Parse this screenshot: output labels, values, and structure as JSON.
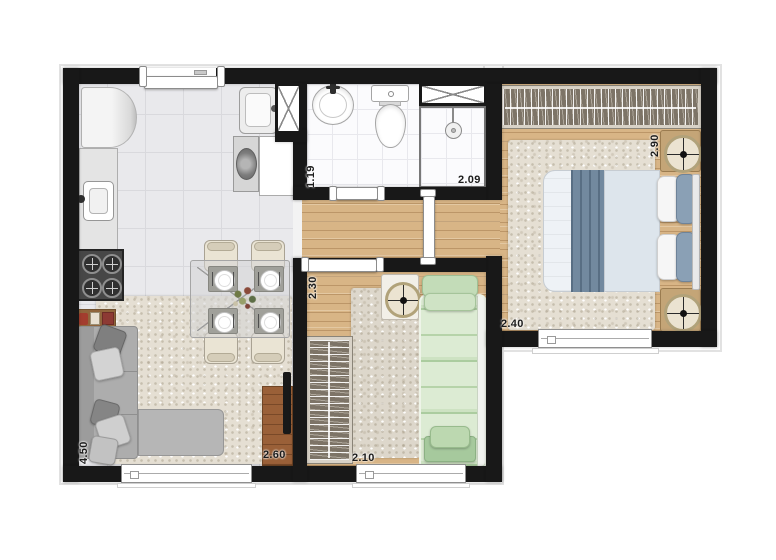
{
  "plan": {
    "type": "apartment-floor-plan",
    "dimensions": {
      "living_depth": "4.50",
      "living_width": "2.60",
      "bathroom_depth": "1.19",
      "bathroom_width": "2.09",
      "bedroom2_depth": "2.30",
      "bedroom2_width": "2.10",
      "master_depth": "2.90",
      "master_width": "2.40"
    },
    "colors": {
      "wall": "#181818",
      "wood_floor": "#d8b586",
      "kitchen_tile": "#e9e9ec",
      "bathroom_tile": "#fbfbfd",
      "rug": "#e5dfd3",
      "master_blanket": "#72899f",
      "single_bed_green": "#cde2c2",
      "sofa_gray": "#adadad",
      "tv_rack_wood": "#9a6038",
      "wardrobe_interior": "#7d7467"
    },
    "icons": [
      "fridge",
      "kitchen-sink",
      "stove",
      "laundry-tank",
      "washing-machine",
      "utility-shaft",
      "bath-sink",
      "toilet",
      "shower",
      "niche",
      "wardrobe",
      "double-bed",
      "single-bed",
      "nightstand-lamp",
      "sofa",
      "dining-table",
      "tv-rack",
      "window",
      "door"
    ]
  }
}
